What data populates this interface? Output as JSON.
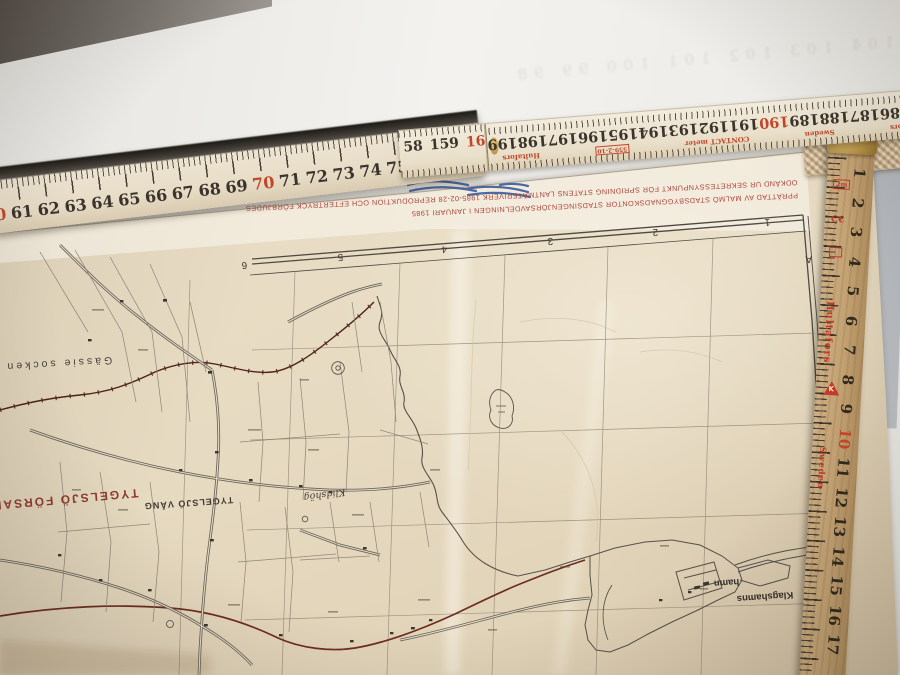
{
  "rulers": {
    "front_horizontal": {
      "numbers": [
        "60",
        "61",
        "62",
        "63",
        "64",
        "65",
        "66",
        "67",
        "68",
        "69",
        "70",
        "71",
        "72",
        "73",
        "74",
        "75",
        "76",
        "77"
      ],
      "red_numbers": [
        "60",
        "70"
      ]
    },
    "rear_horizontal": {
      "near_segment": {
        "n1": "58",
        "n2": "159",
        "n3_red": "16"
      },
      "far_segment_numbers": [
        "185",
        "186",
        "187",
        "188",
        "189",
        "190",
        "191",
        "192",
        "193",
        "194",
        "195",
        "196",
        "197",
        "198",
        "199"
      ],
      "far_segment_red": [
        "190"
      ],
      "brand": "Hultafors",
      "country": "Sweden",
      "model": "CONTACT meter",
      "article_no": "559-2-10"
    },
    "right_vertical": {
      "numbers": [
        "1",
        "2",
        "3",
        "4",
        "5",
        "6",
        "7",
        "8",
        "9",
        "10",
        "11",
        "12",
        "13",
        "14",
        "15",
        "16",
        "17"
      ],
      "red_numbers": [
        "10"
      ],
      "brand": "Hultafors",
      "country": "Sweden",
      "mark_2m": "2m",
      "mark_ce": "C€",
      "mark_k": "K"
    }
  },
  "ghost": {
    "numbers": "104 103 102 101 100 99 98"
  },
  "map": {
    "credit_line_1": "PPRÄTTAD AV MALMÖ STADSBYGGNADSKONTOR STADSINGENJÖRSAVDELNINGEN I JANUARI 1985",
    "credit_line_2": "ODKÄND UR SEKRETESSYNPUNKT FÖR SPRIDNING STATENS LANTMÄTERIVERK 1985-02-28 REPRODUKTION OCH EFTERTRYCK FÖRBJUDES",
    "grid_numbers": [
      "6",
      "5",
      "4",
      "3",
      "2",
      "1"
    ],
    "grid_letters": [
      "A",
      "Z",
      "Y",
      "X"
    ],
    "labels": {
      "socken": "Gässie socken",
      "forsamling": "TYGELSJÖ FÖRSAM",
      "vang": "TYGELSJÖ VÅNG",
      "farm": "Klidshög",
      "harbor_name": "Klagshamns",
      "harbor_word": "hamn"
    },
    "colors": {
      "credit_red": "#b0453a",
      "label_red": "#8f3a2e",
      "boundary_dark_red": "#4d231c",
      "road_red": "#6e2c20"
    }
  }
}
